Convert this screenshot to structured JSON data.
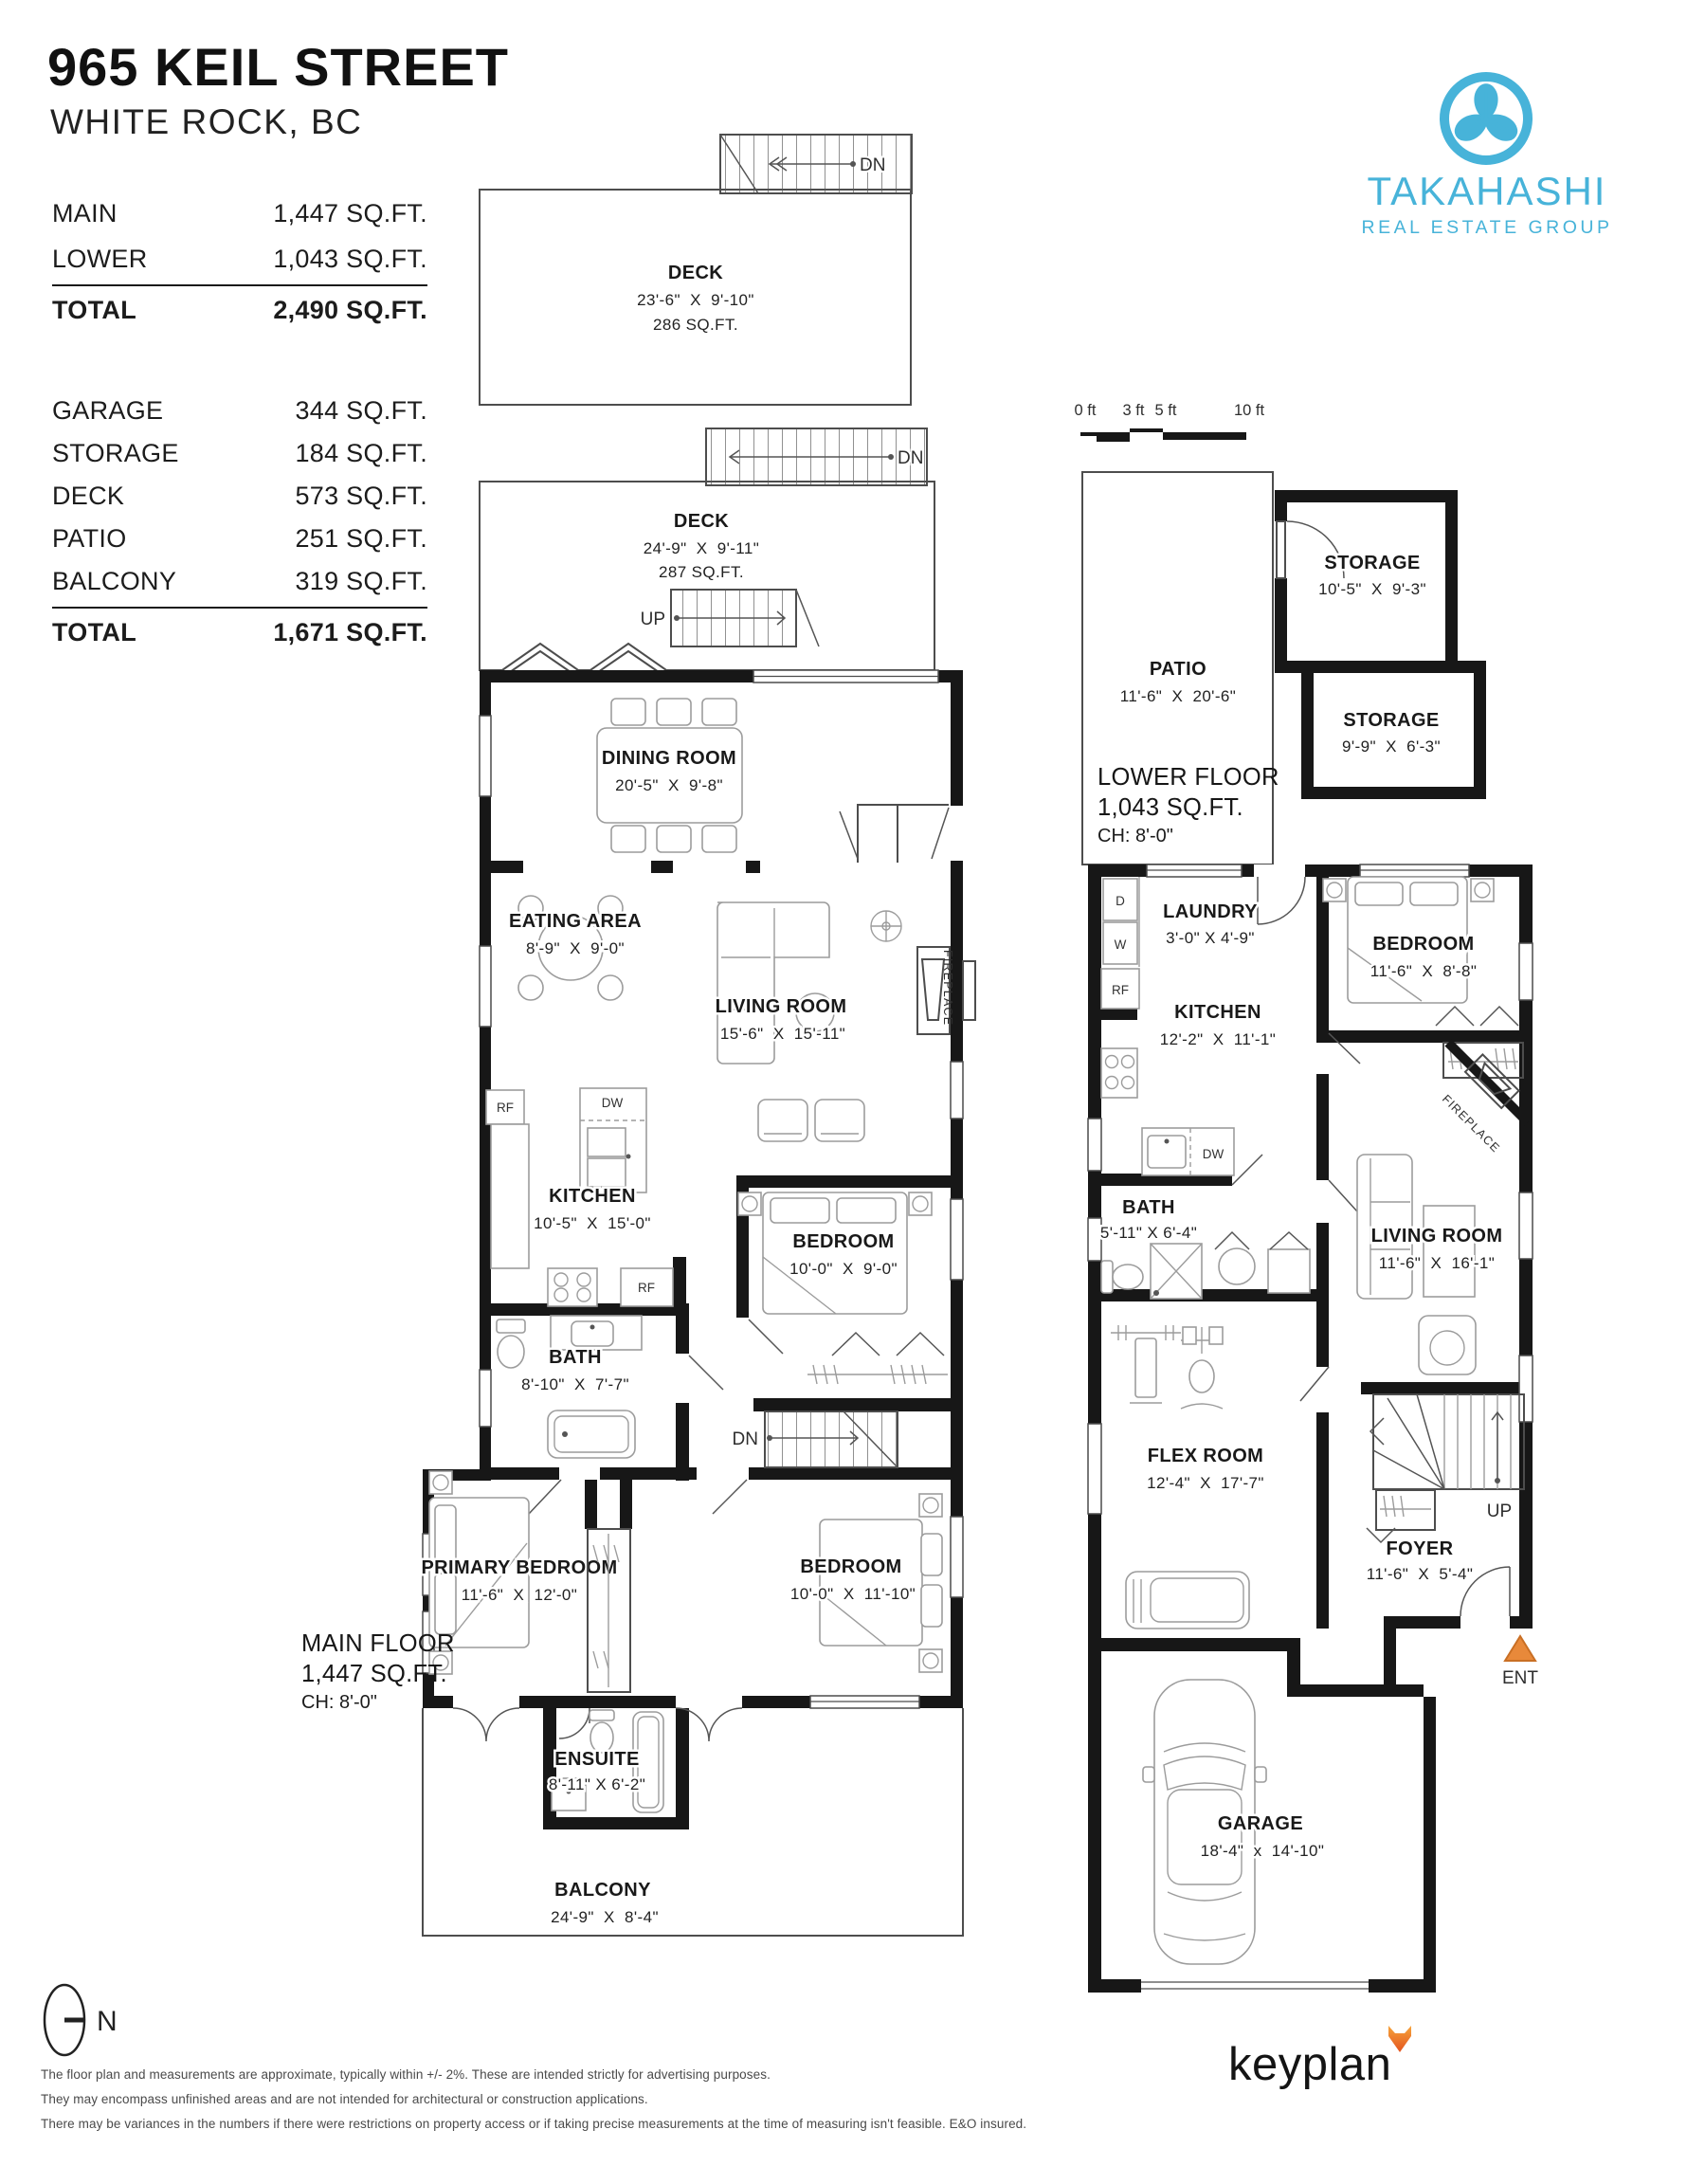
{
  "header": {
    "address": "965 KEIL STREET",
    "city": "WHITE ROCK, BC"
  },
  "summary": {
    "top": [
      {
        "label": "MAIN",
        "value": "1,447 SQ.FT."
      },
      {
        "label": "LOWER",
        "value": "1,043 SQ.FT."
      }
    ],
    "top_total": {
      "label": "TOTAL",
      "value": "2,490 SQ.FT."
    },
    "bottom": [
      {
        "label": "GARAGE",
        "value": "344 SQ.FT."
      },
      {
        "label": "STORAGE",
        "value": "184 SQ.FT."
      },
      {
        "label": "DECK",
        "value": "573 SQ.FT."
      },
      {
        "label": "PATIO",
        "value": "251 SQ.FT."
      },
      {
        "label": "BALCONY",
        "value": "319 SQ.FT."
      }
    ],
    "bottom_total": {
      "label": "TOTAL",
      "value": "1,671 SQ.FT."
    }
  },
  "brand": {
    "name": "TAKAHASHI",
    "tagline": "REAL ESTATE GROUP",
    "color": "#47b3d9"
  },
  "scale_bar": {
    "labels": [
      "0 ft",
      "3 ft",
      "5 ft",
      "10 ft"
    ]
  },
  "glyphs": {
    "dn": "DN",
    "up": "UP",
    "ent": "ENT",
    "fireplace": "FIREPLACE",
    "rf": "RF",
    "dw": "DW",
    "d": "D",
    "w": "W",
    "north": "N"
  },
  "main_floor": {
    "title": "MAIN FLOOR",
    "area": "1,447 SQ.FT.",
    "ceiling": "CH: 8'-0\"",
    "deck_upper": {
      "name": "DECK",
      "dims": "23'-6\"  X  9'-10\"",
      "area": "286 SQ.FT."
    },
    "deck_lower": {
      "name": "DECK",
      "dims": "24'-9\"  X  9'-11\"",
      "area": "287 SQ.FT."
    },
    "dining": {
      "name": "DINING ROOM",
      "dims": "20'-5\"  X  9'-8\""
    },
    "eating": {
      "name": "EATING AREA",
      "dims": "8'-9\"  X  9'-0\""
    },
    "living": {
      "name": "LIVING ROOM",
      "dims": "15'-6\"  X  15'-11\""
    },
    "kitchen": {
      "name": "KITCHEN",
      "dims": "10'-5\"  X  15'-0\""
    },
    "bath": {
      "name": "BATH",
      "dims": "8'-10\"  X  7'-7\""
    },
    "bedroom": {
      "name": "BEDROOM",
      "dims": "10'-0\"  X  9'-0\""
    },
    "primary": {
      "name": "PRIMARY BEDROOM",
      "dims": "11'-6\"  X  12'-0\""
    },
    "bedroom2": {
      "name": "BEDROOM",
      "dims": "10'-0\"  X  11'-10\""
    },
    "ensuite": {
      "name": "ENSUITE",
      "dims": "8'-11\" X 6'-2\""
    },
    "balcony": {
      "name": "BALCONY",
      "dims": "24'-9\"  X  8'-4\""
    }
  },
  "lower_floor": {
    "title": "LOWER FLOOR",
    "area": "1,043 SQ.FT.",
    "ceiling": "CH: 8'-0\"",
    "patio": {
      "name": "PATIO",
      "dims": "11'-6\"  X  20'-6\""
    },
    "storage1": {
      "name": "STORAGE",
      "dims": "10'-5\"  X  9'-3\""
    },
    "storage2": {
      "name": "STORAGE",
      "dims": "9'-9\"  X  6'-3\""
    },
    "laundry": {
      "name": "LAUNDRY",
      "dims": "3'-0\" X 4'-9\""
    },
    "kitchen": {
      "name": "KITCHEN",
      "dims": "12'-2\"  X  11'-1\""
    },
    "bedroom": {
      "name": "BEDROOM",
      "dims": "11'-6\"  X  8'-8\""
    },
    "bath": {
      "name": "BATH",
      "dims": "5'-11\" X 6'-4\""
    },
    "living": {
      "name": "LIVING ROOM",
      "dims": "11'-6\"  X  16'-1\""
    },
    "flex": {
      "name": "FLEX ROOM",
      "dims": "12'-4\"  X  17'-7\""
    },
    "foyer": {
      "name": "FOYER",
      "dims": "11'-6\"  X  5'-4\""
    },
    "garage": {
      "name": "GARAGE",
      "dims": "18'-4\"  x  14'-10\""
    }
  },
  "footer": {
    "disclaimer": [
      "The floor plan and measurements are approximate, typically within +/- 2%. These are intended strictly for advertising purposes.",
      "They may encompass unfinished areas and are not intended for architectural or construction applications.",
      "There may be variances in the numbers if there were restrictions on property access or if taking precise measurements at the time of measuring isn't feasible. E&O insured."
    ],
    "brand": "keyplan"
  }
}
